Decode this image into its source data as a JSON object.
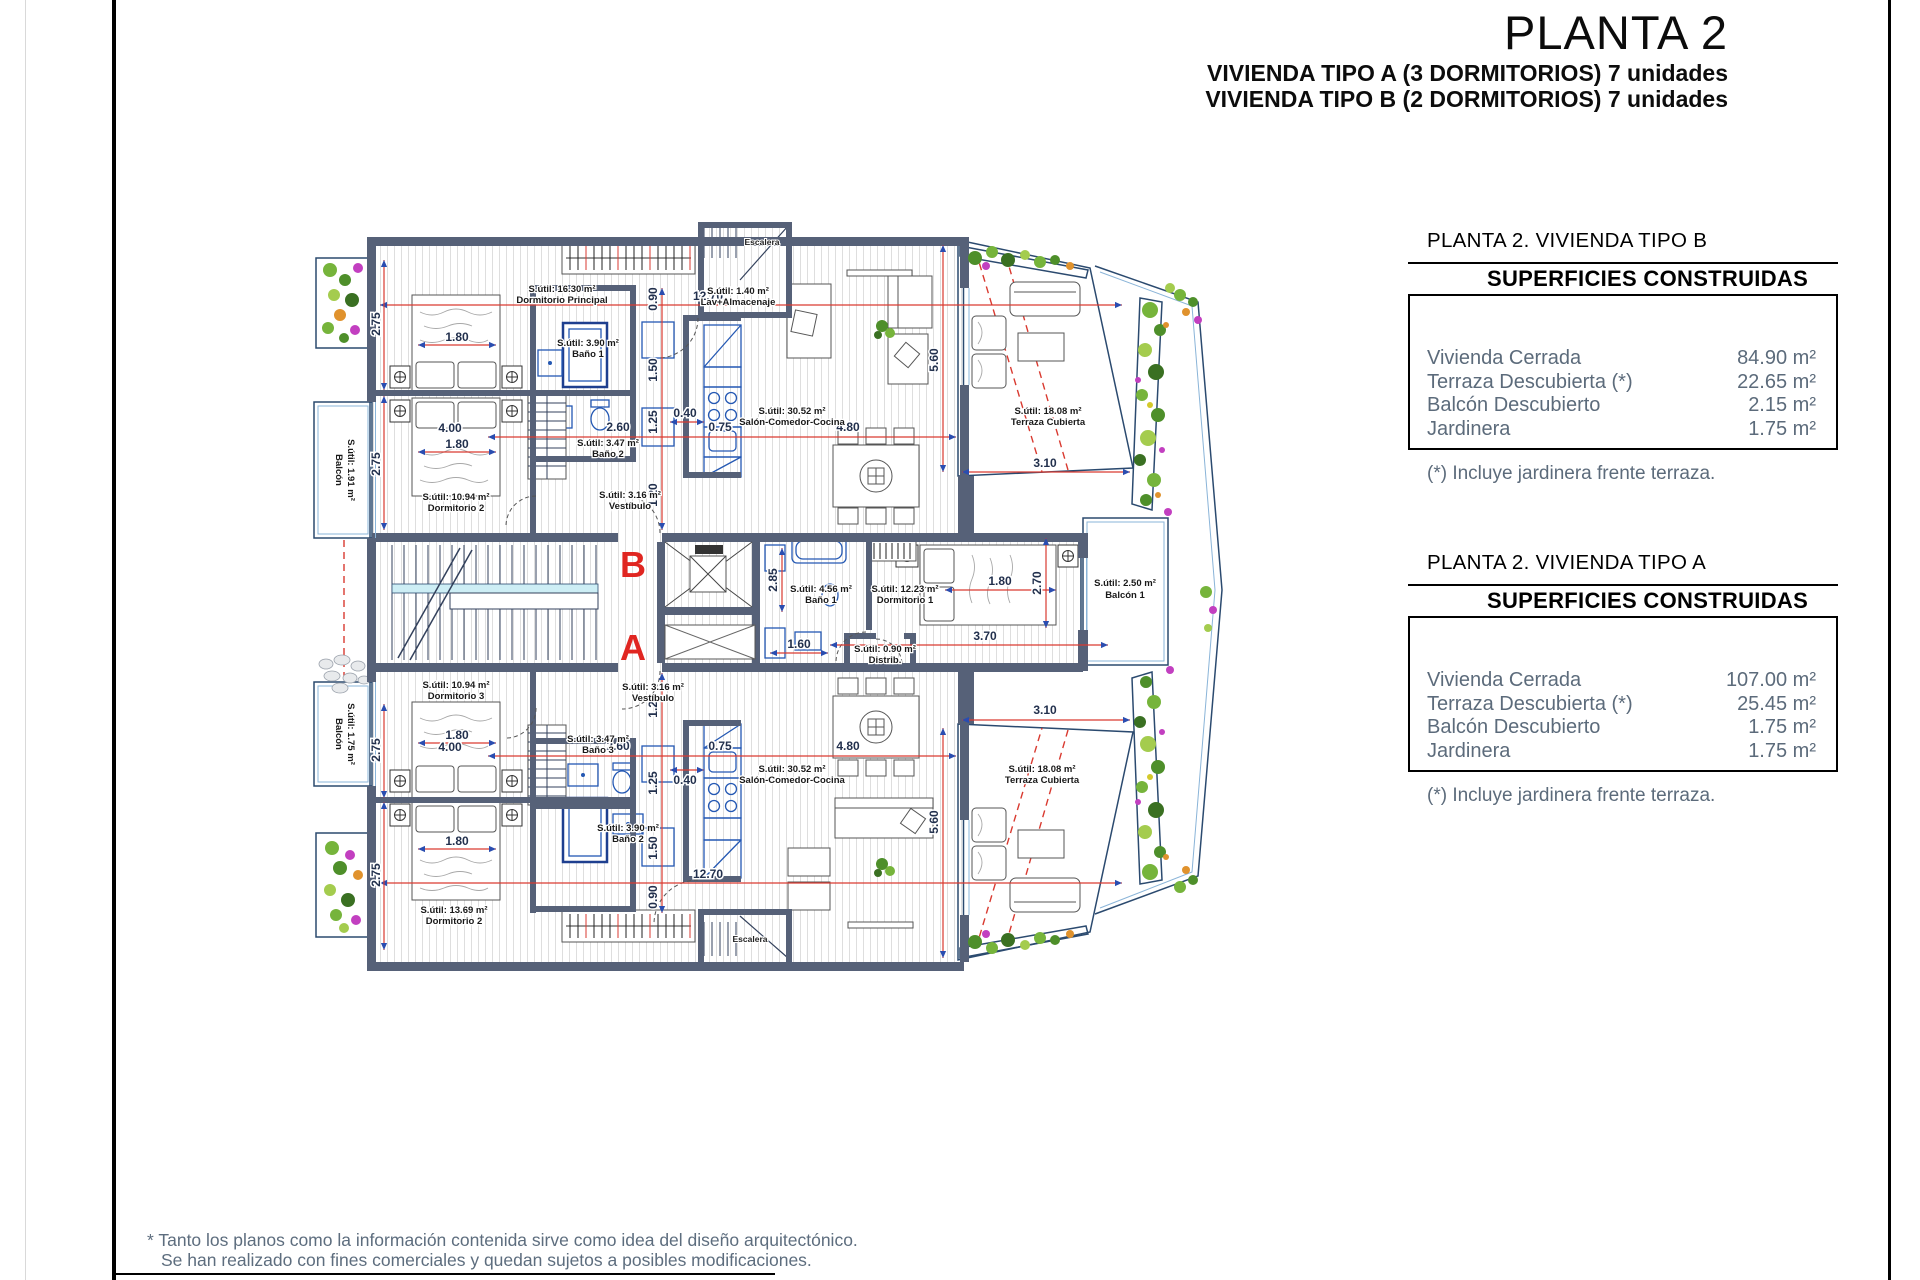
{
  "header": {
    "title": "PLANTA 2",
    "subtitle_a": "VIVIENDA TIPO A (3 DORMITORIOS) 7 unidades",
    "subtitle_b": "VIVIENDA TIPO B (2 DORMITORIOS) 7 unidades"
  },
  "tables": [
    {
      "header": "PLANTA 2. VIVIENDA TIPO B",
      "box_title": "SUPERFICIES CONSTRUIDAS",
      "rows": [
        {
          "label": "Vivienda Cerrada",
          "value": "84.90 m²"
        },
        {
          "label": "Terraza Descubierta (*)",
          "value": "22.65 m²"
        },
        {
          "label": "Balcón Descubierto",
          "value": "2.15 m²"
        },
        {
          "label": "Jardinera",
          "value": "1.75 m²"
        }
      ],
      "footnote": "(*) Incluye jardinera frente terraza."
    },
    {
      "header": "PLANTA 2. VIVIENDA TIPO A",
      "box_title": "SUPERFICIES CONSTRUIDAS",
      "rows": [
        {
          "label": "Vivienda Cerrada",
          "value": "107.00 m²"
        },
        {
          "label": "Terraza Descubierta (*)",
          "value": "25.45 m²"
        },
        {
          "label": "Balcón Descubierto",
          "value": "1.75 m²"
        },
        {
          "label": "Jardinera",
          "value": "1.75 m²"
        }
      ],
      "footnote": "(*) Incluye jardinera frente terraza."
    }
  ],
  "disclaimer": {
    "line1": "* Tanto los planos como la información contenida sirve como idea del diseño arquitectónico.",
    "line2": "Se han realizado con fines comerciales y quedan sujetos a posibles modificaciones."
  },
  "plan": {
    "markers": {
      "b": "B",
      "a": "A"
    },
    "rooms": {
      "dorm_principal": {
        "area": "S.útil: 16.30 m²",
        "name": "Dormitorio Principal"
      },
      "dorm2_b": {
        "area": "S.útil: 10.94 m²",
        "name": "Dormitorio 2"
      },
      "bano1_b": {
        "area": "S.útil: 3.90 m²",
        "name": "Baño 1"
      },
      "bano2_b": {
        "area": "S.útil: 3.47 m²",
        "name": "Baño 2"
      },
      "vestibulo_b": {
        "area": "S.útil: 3.16 m²",
        "name": "Vestíbulo"
      },
      "lav": {
        "area": "S.útil: 1.40 m²",
        "name": "Lav+Almacenaje"
      },
      "salon_b": {
        "area": "S.útil: 30.52 m²",
        "name": "Salón-Comedor-Cocina"
      },
      "terraza_b": {
        "area": "S.útil: 18.08 m²",
        "name": "Terraza Cubierta"
      },
      "balcon_b": {
        "name": "Balcón",
        "area": "S.útil: 1.91 m²"
      },
      "escalera": "Escalera",
      "dorm1_a": {
        "area": "S.útil: 12.23 m²",
        "name": "Dormitorio 1"
      },
      "bano1_a": {
        "area": "S.útil: 4.56 m²",
        "name": "Baño 1"
      },
      "distrib": {
        "area": "S.útil: 0.90 m²",
        "name": "Distrib."
      },
      "balcon1_a": {
        "area": "S.útil: 2.50 m²",
        "name": "Balcón 1"
      },
      "dorm3_a": {
        "area": "S.útil: 10.94 m²",
        "name": "Dormitorio 3"
      },
      "bano3_a": {
        "area": "S.útil: 3.47 m²",
        "name": "Baño 3"
      },
      "bano2_a": {
        "area": "S.útil: 3.90 m²",
        "name": "Baño 2"
      },
      "vestibulo_a": {
        "area": "S.útil: 3.16 m²",
        "name": "Vestíbulo"
      },
      "dorm2_a": {
        "area": "S.útil: 13.69 m²",
        "name": "Dormitorio 2"
      },
      "salon_a": {
        "area": "S.útil: 30.52 m²",
        "name": "Salón-Comedor-Cocina"
      },
      "terraza_a": {
        "area": "S.útil: 18.08 m²",
        "name": "Terraza Cubierta"
      },
      "balcon_a": {
        "name": "Balcón",
        "area": "S.útil: 1.75 m²"
      }
    },
    "dims": {
      "d1270": "12.70",
      "d560": "5.60",
      "d275": "2.75",
      "d180": "1.80",
      "d400": "4.00",
      "d260": "2.60",
      "d125": "1.25",
      "d150": "1.50",
      "d120": "1.20",
      "d090": "0.90",
      "d040": "0.40",
      "d075": "0.75",
      "d480": "4.80",
      "d310": "3.10",
      "d270": "2.70",
      "d370": "3.70",
      "d160": "1.60",
      "d285": "2.85"
    },
    "colors": {
      "wall": "#566178",
      "dim_red": "#d93a30",
      "dim_blue": "#2a4db0",
      "fixture_blue": "#2458b3",
      "marker_red": "#e02621",
      "plant_green": "#76b43b",
      "plant_magenta": "#c23fc0",
      "plant_orange": "#e0922d"
    }
  }
}
